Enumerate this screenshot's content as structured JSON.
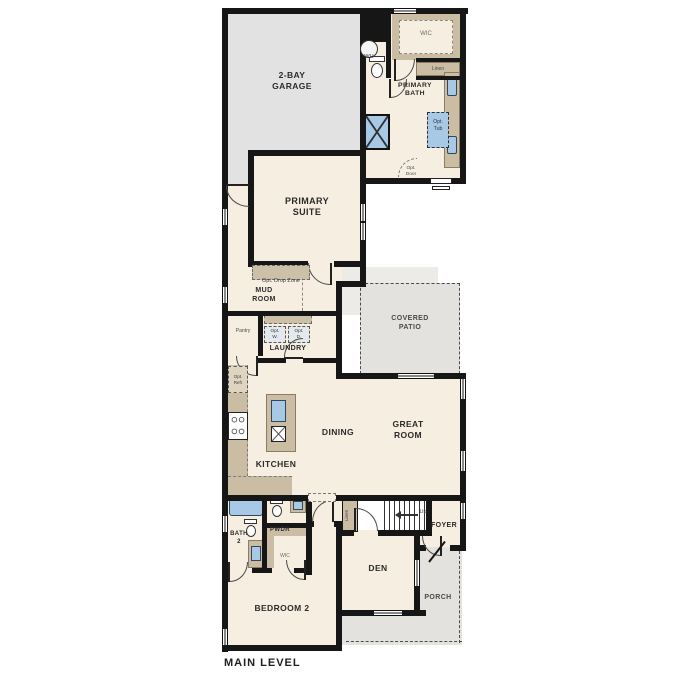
{
  "title": "MAIN LEVEL",
  "colors": {
    "wall": "#161616",
    "floor": "#f6efe1",
    "garage": "#e2e2e2",
    "patio": "#e3e2de",
    "porch": "#e3e2df",
    "cabinet": "#cabda3",
    "fixture_blue": "#a7c9e6",
    "optional_fill": "#e3e9ec"
  },
  "rooms": {
    "garage": "2-BAY\nGARAGE",
    "wic_primary": "WIC",
    "linen_upper": "Linen",
    "primary_bath": "PRIMARY\nBATH",
    "primary_suite": "PRIMARY\nSUITE",
    "mud_room": "MUD\nROOM",
    "pantry": "Pantry",
    "laundry": "LAUNDRY",
    "covered_patio": "COVERED\nPATIO",
    "kitchen": "KITCHEN",
    "dining": "DINING",
    "great_room": "GREAT\nROOM",
    "bath_2": "BATH\n2",
    "powder": "PWDR",
    "wic_bedroom2": "WIC",
    "linen_stairs": "Linen",
    "foyer": "FOYER",
    "den": "DEN",
    "bedroom_2": "BEDROOM 2",
    "porch": "PORCH"
  },
  "annotations": {
    "water_heater": "WH",
    "opt_tub": "Opt.\nTub",
    "opt_door": "Opt.\nDoor",
    "opt_drop_zone": "Opt. Drop Zone",
    "opt_cabs": "Opt. Cabs",
    "opt_washer": "Opt.\nW.",
    "opt_dryer": "Opt.\nD.",
    "opt_refr": "Opt.\nRefr",
    "stairs_up": "Up"
  }
}
